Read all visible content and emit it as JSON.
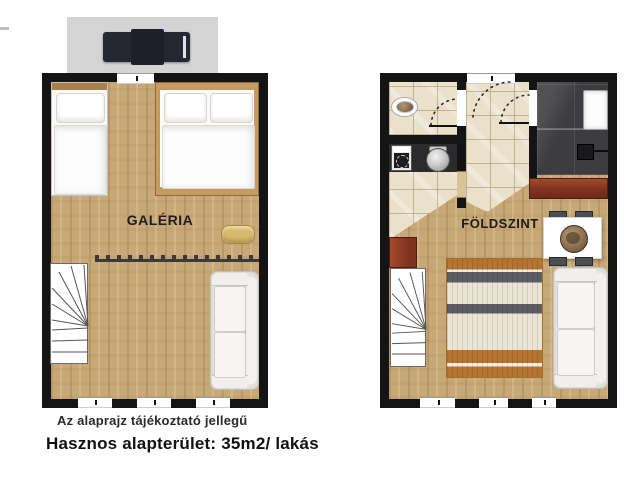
{
  "plans": {
    "galeria": {
      "label": "GALÉRIA"
    },
    "foldszint": {
      "label": "FÖLDSZINT"
    }
  },
  "footer": {
    "note": "Az alaprajz tájékoztató jellegű",
    "area": "Hasznos alapterület: 35m2/ lakás"
  },
  "colors": {
    "wall": "#141414",
    "wood_floor": "#c9a877",
    "beige_tile": "#ebe1cb",
    "shower_tile": "#3d3d40",
    "kitchen_counter": "#2b2b2d",
    "red_cabinet": "#7e3220",
    "stripe_orange": "#b5742f",
    "stripe_gray": "#5d5c62",
    "sofa": "#e9e7e2",
    "roof_box": "#d4d4d4",
    "roof_window": "#252833",
    "pouf": "#d9b96a"
  }
}
